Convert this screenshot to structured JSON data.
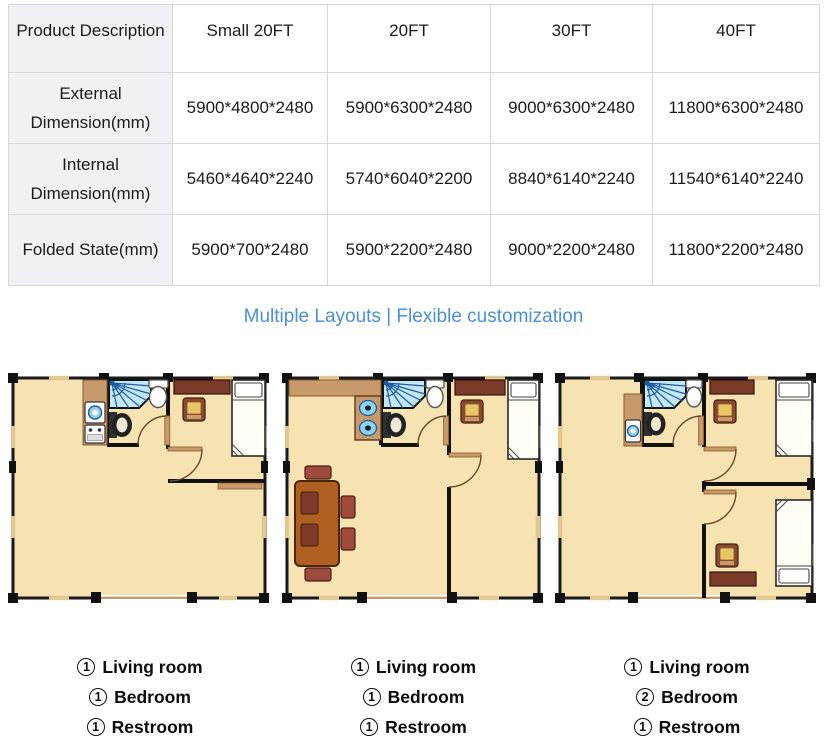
{
  "table": {
    "header": [
      "Product Description",
      "Small 20FT",
      "20FT",
      "30FT",
      "40FT"
    ],
    "rows": [
      {
        "label": "External Dimension(mm)",
        "values": [
          "5900*4800*2480",
          "5900*6300*2480",
          "9000*6300*2480",
          "11800*6300*2480"
        ]
      },
      {
        "label": "Internal Dimension(mm)",
        "values": [
          "5460*4640*2240",
          "5740*6040*2200",
          "8840*6140*2240",
          "11540*6140*2240"
        ]
      },
      {
        "label": "Folded State(mm)",
        "values": [
          "5900*700*2480",
          "5900*2200*2480",
          "9000*2200*2480",
          "11800*2200*2480"
        ]
      }
    ]
  },
  "heading": {
    "text": "Multiple Layouts | Flexible customization"
  },
  "colors": {
    "accent_blue": "#4A90D9",
    "floor": "#F7E2B2",
    "wall": "#1A1A1A",
    "counter_tan": "#C79A6B",
    "dresser_brown": "#7B3B28",
    "table_brown": "#B06020",
    "cushion_gold": "#E9C568",
    "shower_blue": "#C2E7F6",
    "shower_line_blue": "#1E5C9E",
    "appliance_blue": "#8FD0EA",
    "header_cell_bg": "#F0F0F5",
    "table_border": "#D8D8D8"
  },
  "floorplans": [
    {
      "name": "Small 20FT layout",
      "legend": [
        {
          "num": "1",
          "label": "Living room"
        },
        {
          "num": "1",
          "label": "Bedroom"
        },
        {
          "num": "1",
          "label": "Restroom"
        }
      ]
    },
    {
      "name": "20FT layout",
      "legend": [
        {
          "num": "1",
          "label": "Living room"
        },
        {
          "num": "1",
          "label": "Bedroom"
        },
        {
          "num": "1",
          "label": "Restroom"
        }
      ]
    },
    {
      "name": "30FT/40FT layout",
      "legend": [
        {
          "num": "1",
          "label": "Living room"
        },
        {
          "num": "2",
          "label": "Bedroom"
        },
        {
          "num": "1",
          "label": "Restroom"
        }
      ]
    }
  ]
}
